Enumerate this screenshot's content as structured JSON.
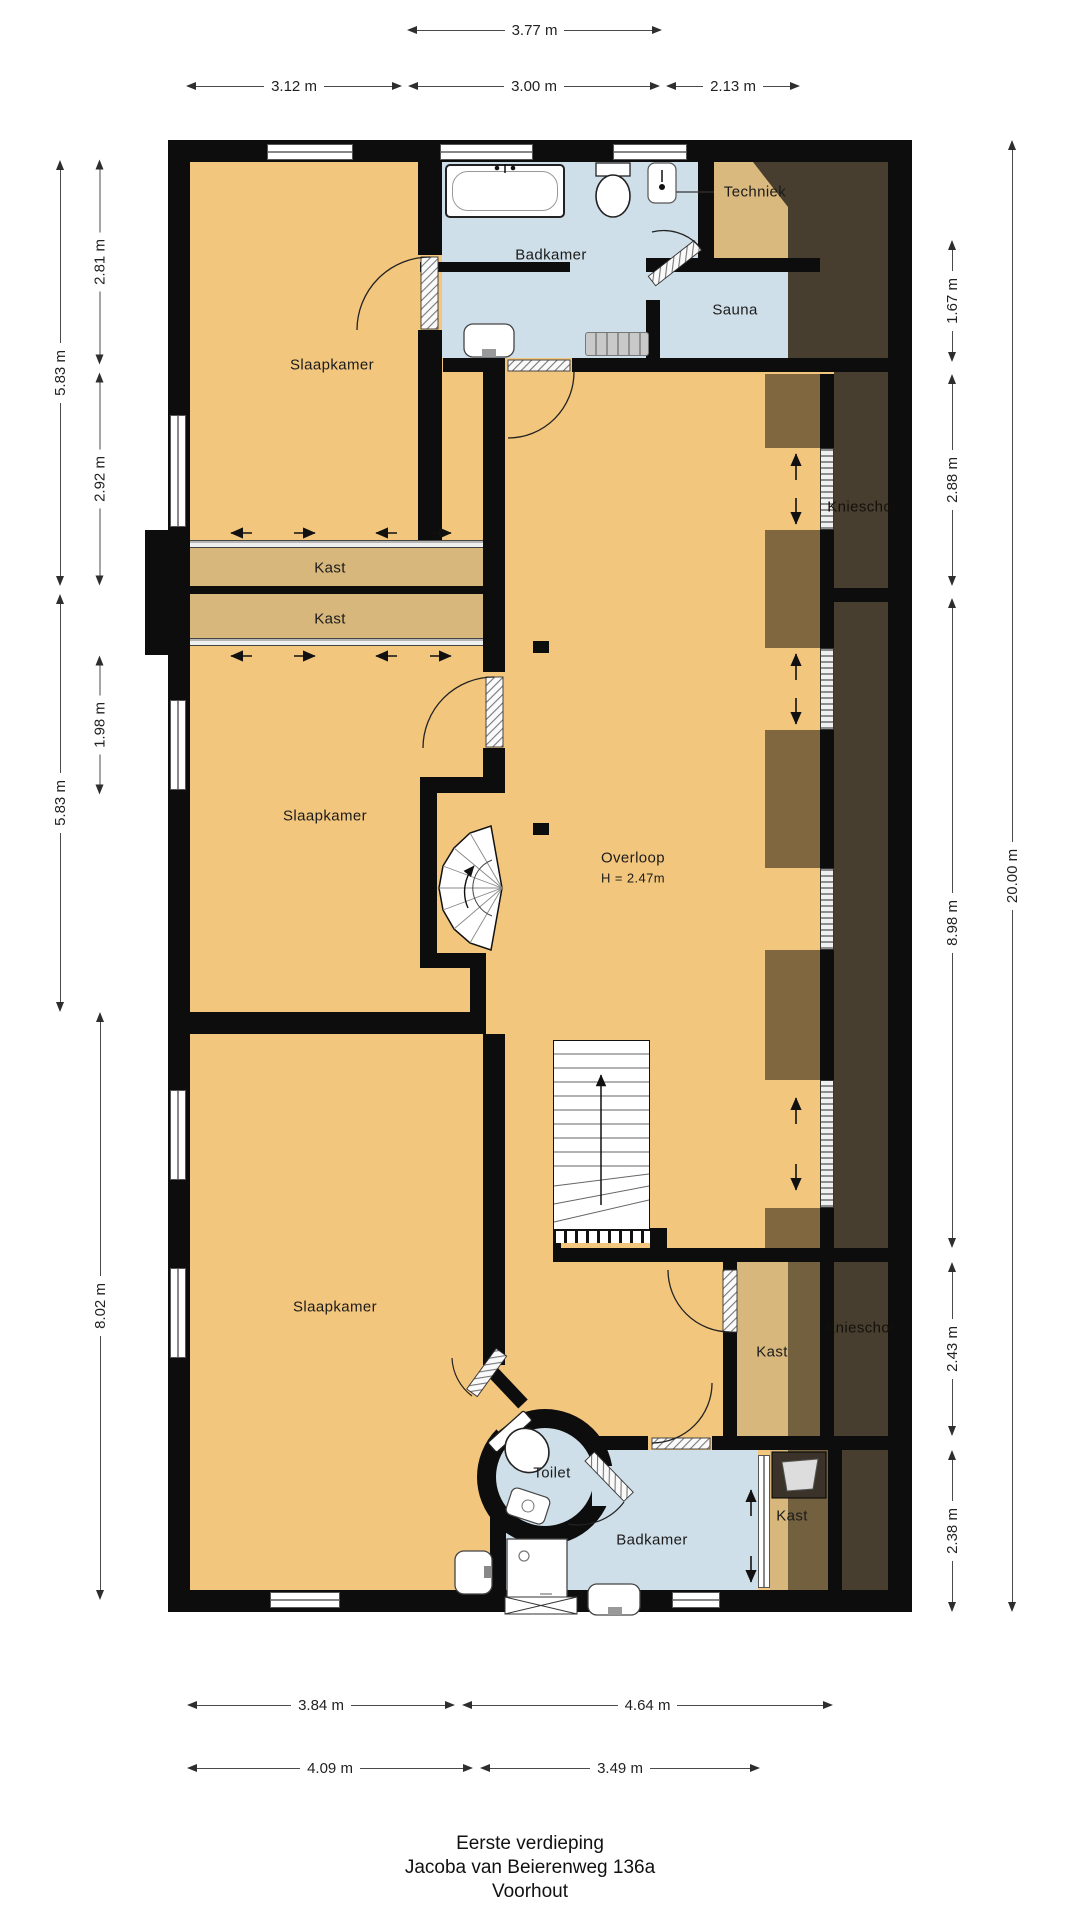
{
  "title": {
    "line1": "Eerste verdieping",
    "line2": "Jacoba van Beierenweg 136a",
    "line3": "Voorhout"
  },
  "rooms": {
    "slaapkamer_top": "Slaapkamer",
    "badkamer_top": "Badkamer",
    "techniek": "Techniek",
    "sauna": "Sauna",
    "kast_1": "Kast",
    "kast_2": "Kast",
    "slaapkamer_mid": "Slaapkamer",
    "overloop": "Overloop",
    "overloop_height": "H = 2.47m",
    "knieschot_top": "Knieschot",
    "knieschot_bottom": "Knieschot",
    "slaapkamer_bottom": "Slaapkamer",
    "kast_right_top": "Kast",
    "kast_right_bottom": "Kast",
    "toilet": "Toilet",
    "badkamer_bottom": "Badkamer"
  },
  "dimensions": {
    "top_outer": "3.77 m",
    "top_inner": [
      "3.12 m",
      "3.00 m",
      "2.13 m"
    ],
    "left_outer": [
      "5.83 m",
      "5.83 m"
    ],
    "left_inner": [
      "2.81 m",
      "2.92 m",
      "1.98 m",
      "8.02 m"
    ],
    "right_inner": [
      "1.67 m",
      "2.88 m",
      "8.98 m",
      "2.43 m",
      "2.38 m"
    ],
    "right_outer": "20.00 m",
    "bottom_upper": [
      "3.84 m",
      "4.64 m"
    ],
    "bottom_lower": [
      "4.09 m",
      "3.49 m"
    ]
  },
  "colors": {
    "floor_orange": "#f3c67e",
    "closet_tan": "#d7b77c",
    "wet_room_blue": "#cfdfe9",
    "attic_dark": "#473e30",
    "wall_black": "#0d0d0d"
  }
}
